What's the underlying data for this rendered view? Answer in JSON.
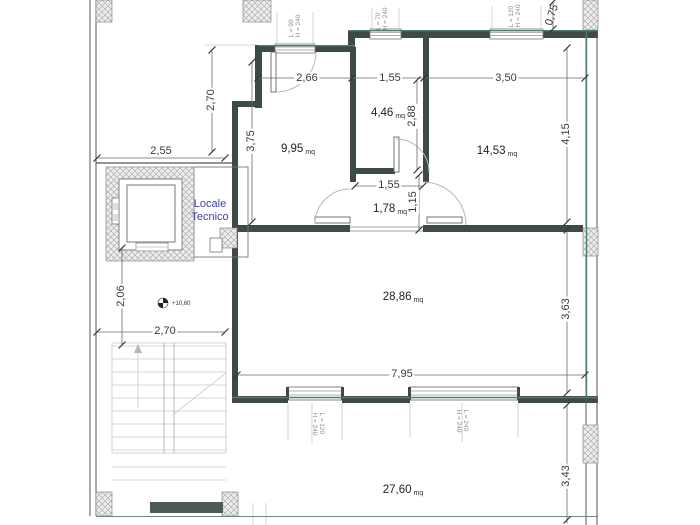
{
  "plan": {
    "rooms": [
      {
        "value": "9,95",
        "unit": "mq"
      },
      {
        "value": "4,46",
        "unit": "mq"
      },
      {
        "value": "14,53",
        "unit": "mq"
      },
      {
        "value": "1,78",
        "unit": "mq"
      },
      {
        "value": "28,86",
        "unit": "mq"
      },
      {
        "value": "27,60",
        "unit": "mq"
      }
    ],
    "dimensions": [
      {
        "text": "2,70"
      },
      {
        "text": "2,55"
      },
      {
        "text": "3,75"
      },
      {
        "text": "2,66"
      },
      {
        "text": "1,55"
      },
      {
        "text": "3,50"
      },
      {
        "text": "2,88"
      },
      {
        "text": "4,15"
      },
      {
        "text": "1,55"
      },
      {
        "text": "1,15"
      },
      {
        "text": "2,06"
      },
      {
        "text": "2,70"
      },
      {
        "text": "7,95"
      },
      {
        "text": "3,63"
      },
      {
        "text": "3,43"
      },
      {
        "text": "0,75"
      }
    ],
    "openings": [
      {
        "l": "L = 90",
        "h": "H = 240"
      },
      {
        "l": "L = 70",
        "h": "H = 240"
      },
      {
        "l": "L = 120",
        "h": "H = 240"
      },
      {
        "l": "L = 120",
        "h": "H = 240"
      },
      {
        "l": "L = 240",
        "h": "H = 240"
      }
    ],
    "labels": {
      "technical_room_line1": "Locale",
      "technical_room_line2": "Tecnico",
      "level_marker": "+10,60"
    },
    "colors": {
      "wall": "#3e4a46",
      "accent_green": "#4f7e6a",
      "technical_room_text": "#4040a8"
    }
  }
}
